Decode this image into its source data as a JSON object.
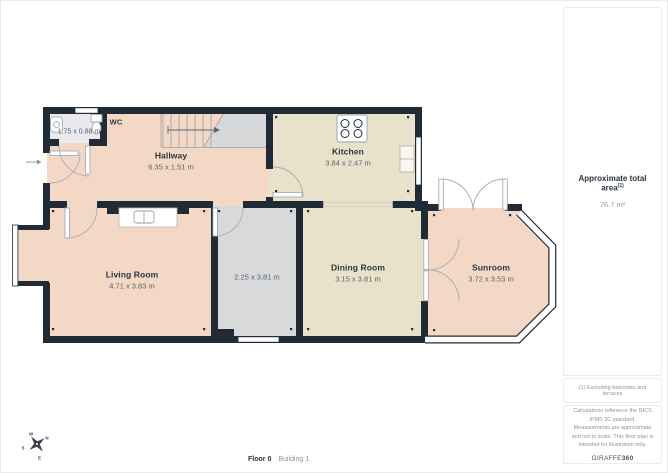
{
  "rooms": {
    "wc": {
      "name": "WC",
      "dims": "1.75 x 0.88 m"
    },
    "hallway": {
      "name": "Hallway",
      "dims": "6.35 x 1.51 m"
    },
    "kitchen": {
      "name": "Kitchen",
      "dims": "3.84 x 2.47 m"
    },
    "living_room": {
      "name": "Living Room",
      "dims": "4.71 x 3.83 m"
    },
    "middle_room": {
      "name": "",
      "dims": "2.25 x 3.81 m"
    },
    "dining_room": {
      "name": "Dining Room",
      "dims": "3.15 x 3.81 m"
    },
    "sunroom": {
      "name": "Sunroom",
      "dims": "3.72 x 3.53 m"
    }
  },
  "compass": {
    "n": "N",
    "e": "E",
    "s": "S",
    "w": "W"
  },
  "sidebar": {
    "area_title": "Approximate total area",
    "area_marker": "(1)",
    "area_value": "76.7 m²",
    "footnote": "(1) Excluding balconies and terraces",
    "disclaimer": "Calculations reference the RICS IPMS 3C standard. Measurements are approximate and not to scale. This floor plan is intended for illustration only.",
    "brand_name": "GIRAFFE",
    "brand_suffix": "360"
  },
  "footer": {
    "floor_label": "Floor 0",
    "building_label": "Building 1"
  },
  "icons": {
    "compass": "compass-rose",
    "stairs": "staircase-up-arrow",
    "stove": "stove-four-burners",
    "entrance": "entrance-arrow"
  },
  "colors": {
    "wall": "#212b38",
    "floor_salmon": "#f4d8c6",
    "floor_beige": "#e9e2ca",
    "floor_gray": "#d8d9da",
    "floor_wc": "#e9e9ef",
    "panel_border": "#ececec",
    "muted_text": "#8f959b"
  }
}
